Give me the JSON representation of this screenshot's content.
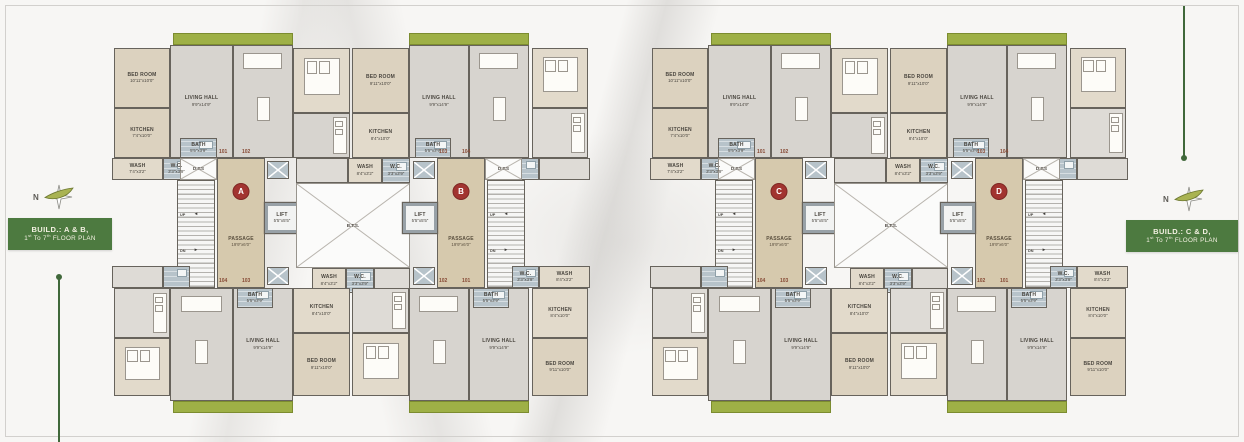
{
  "sheet": {
    "width": 1244,
    "height": 442,
    "background": "#f7f6f4"
  },
  "colors": {
    "wall": "#67635c",
    "room_beige": "#dcd2bf",
    "room_gray": "#d7d4cf",
    "bath_blue": "#b7c3ca",
    "balcony_green": "#9eb046",
    "title_green": "#4d7a40",
    "unit_circle_red": "#a23430",
    "unit_number": "#874a35",
    "line_green": "#40683a"
  },
  "annotations": {
    "left": {
      "n": "N",
      "line1": "BUILD.: A & B,",
      "line2": [
        "1",
        "st",
        " To 7",
        "th",
        " FLOOR PLAN"
      ]
    },
    "right": {
      "n": "N",
      "line1": "BUILD.: C & D,",
      "line2": [
        "1",
        "st",
        " To 7",
        "th",
        " FLOOR PLAN"
      ]
    }
  },
  "labels": {
    "passage": "PASSAGE",
    "passage_dims": "19'9\"x6'0\"",
    "lift": "LIFT",
    "lift_dims": "5'5\"x5'5\"",
    "dts": "D.T.S",
    "bts": "B.T.S.",
    "up": "UP",
    "dn": "DN",
    "arrow_left": "◄",
    "arrow_right": "►"
  },
  "plans": [
    {
      "name": "plan-build-ab",
      "x": 112,
      "letters": [
        "A",
        "B"
      ]
    },
    {
      "name": "plan-build-cd",
      "x": 650,
      "letters": [
        "C",
        "D"
      ]
    }
  ],
  "plan_template": {
    "items": [
      {
        "type": "green",
        "id": "balcony-top-left",
        "x": 61,
        "y": 2,
        "w": 120,
        "h": 12
      },
      {
        "type": "green",
        "id": "balcony-top-right",
        "x": 297,
        "y": 2,
        "w": 120,
        "h": 12
      },
      {
        "type": "green",
        "id": "balcony-bottom-left",
        "x": 61,
        "y": 370,
        "w": 120,
        "h": 12
      },
      {
        "type": "green",
        "id": "balcony-bottom-right",
        "x": 297,
        "y": 370,
        "w": 120,
        "h": 12
      },
      {
        "type": "room",
        "id": "bedroom-101",
        "x": 2,
        "y": 17,
        "w": 56,
        "h": 60,
        "fill": "beige",
        "label": [
          "BED ROOM",
          "10'11\"x10'0\""
        ]
      },
      {
        "type": "room",
        "id": "living-hall-101",
        "x": 58,
        "y": 14,
        "w": 63,
        "h": 113,
        "fill": "gray",
        "label": [
          "LIVING HALL",
          "9'9\"x14'9\""
        ]
      },
      {
        "type": "room",
        "id": "kitchen-101",
        "x": 2,
        "y": 77,
        "w": 56,
        "h": 50,
        "fill": "beige",
        "label": [
          "KITCHEN",
          "7'4\"x10'0\""
        ]
      },
      {
        "type": "room",
        "id": "wash-101",
        "x": 0,
        "y": 127,
        "w": 51,
        "h": 22,
        "fill": "beige2",
        "label": [
          "WASH",
          "7'4\"x3'2\""
        ]
      },
      {
        "type": "room",
        "id": "wc-101",
        "x": 51,
        "y": 127,
        "w": 27,
        "h": 22,
        "fill": "blue",
        "label": [
          "W.C.",
          "3'3\"x3'9\""
        ]
      },
      {
        "type": "room",
        "id": "bath-101",
        "x": 68,
        "y": 107,
        "w": 37,
        "h": 20,
        "fill": "blue",
        "label": [
          "BATH",
          "5'5\"x3'9\""
        ]
      },
      {
        "type": "room",
        "id": "living-hall-102",
        "x": 121,
        "y": 14,
        "w": 60,
        "h": 113,
        "fill": "gray",
        "furn": "sofa"
      },
      {
        "type": "room",
        "id": "bedroom-102",
        "x": 181,
        "y": 17,
        "w": 57,
        "h": 65,
        "fill": "beige2",
        "furn": "bed"
      },
      {
        "type": "room",
        "id": "kitchen-102",
        "x": 181,
        "y": 82,
        "w": 57,
        "h": 45,
        "fill": "gray",
        "furn": "kitchen"
      },
      {
        "type": "room",
        "id": "service-102",
        "x": 184,
        "y": 127,
        "w": 52,
        "h": 25,
        "fill": "gray2"
      },
      {
        "type": "room",
        "id": "wash-103-top",
        "x": 236,
        "y": 127,
        "w": 34,
        "h": 25,
        "fill": "beige2",
        "label": [
          "WASH",
          "8'4\"x3'2\""
        ]
      },
      {
        "type": "room",
        "id": "wc-103-top",
        "x": 270,
        "y": 127,
        "w": 28,
        "h": 25,
        "fill": "blue",
        "label": [
          "W.C.",
          "3'3\"x3'9\""
        ]
      },
      {
        "type": "room",
        "id": "bedroom-103",
        "x": 240,
        "y": 17,
        "w": 57,
        "h": 65,
        "fill": "beige",
        "label": [
          "BED ROOM",
          "9'11\"x10'0\""
        ]
      },
      {
        "type": "room",
        "id": "kitchen-103",
        "x": 240,
        "y": 82,
        "w": 57,
        "h": 45,
        "fill": "beige2",
        "label": [
          "KITCHEN",
          "8'4\"x10'0\""
        ]
      },
      {
        "type": "room",
        "id": "living-hall-103",
        "x": 297,
        "y": 14,
        "w": 60,
        "h": 113,
        "fill": "gray",
        "label": [
          "LIVING HALL",
          "9'9\"x14'9\""
        ]
      },
      {
        "type": "room",
        "id": "bath-103",
        "x": 303,
        "y": 107,
        "w": 36,
        "h": 20,
        "fill": "blue",
        "label": [
          "BATH",
          "5'5\"x3'9\""
        ]
      },
      {
        "type": "room",
        "id": "living-hall-104",
        "x": 357,
        "y": 14,
        "w": 60,
        "h": 113,
        "fill": "gray",
        "furn": "sofa"
      },
      {
        "type": "room",
        "id": "bedroom-104",
        "x": 420,
        "y": 17,
        "w": 56,
        "h": 60,
        "fill": "beige2",
        "furn": "bed"
      },
      {
        "type": "room",
        "id": "kitchen-104",
        "x": 420,
        "y": 77,
        "w": 56,
        "h": 50,
        "fill": "gray2",
        "furn": "kitchen"
      },
      {
        "type": "room",
        "id": "wash-104",
        "x": 427,
        "y": 127,
        "w": 51,
        "h": 22,
        "fill": "gray2"
      },
      {
        "type": "room",
        "id": "wc-104",
        "x": 400,
        "y": 127,
        "w": 27,
        "h": 22,
        "fill": "blue"
      },
      {
        "type": "dts",
        "id": "dts-left",
        "x": 68,
        "y": 127,
        "w": 37,
        "h": 22
      },
      {
        "type": "stairs",
        "id": "staircase-left",
        "x": 65,
        "y": 149,
        "w": 38,
        "h": 108
      },
      {
        "type": "passage",
        "id": "passage-left",
        "x": 105,
        "y": 127,
        "w": 48,
        "h": 130,
        "li": 0
      },
      {
        "type": "lift",
        "id": "lift-left",
        "x": 153,
        "y": 172,
        "w": 34,
        "h": 30
      },
      {
        "type": "bluebox",
        "id": "duct-left-top",
        "x": 155,
        "y": 130,
        "w": 22,
        "h": 18
      },
      {
        "type": "bluebox",
        "id": "duct-left-bottom",
        "x": 155,
        "y": 236,
        "w": 22,
        "h": 18
      },
      {
        "type": "num",
        "id": "unit-101",
        "x": 107,
        "y": 118,
        "t": "101"
      },
      {
        "type": "num",
        "id": "unit-102",
        "x": 130,
        "y": 118,
        "t": "102"
      },
      {
        "type": "num",
        "id": "unit-104",
        "x": 107,
        "y": 247,
        "t": "104"
      },
      {
        "type": "num",
        "id": "unit-103",
        "x": 130,
        "y": 247,
        "t": "103"
      },
      {
        "type": "void",
        "id": "bts-void",
        "x": 184,
        "y": 152,
        "w": 114,
        "h": 85
      },
      {
        "type": "room",
        "id": "wash-103-bottom",
        "x": 200,
        "y": 237,
        "w": 34,
        "h": 25,
        "fill": "beige2",
        "label": [
          "WASH",
          "8'4\"x3'2\""
        ]
      },
      {
        "type": "room",
        "id": "wc-103-bottom",
        "x": 234,
        "y": 237,
        "w": 28,
        "h": 25,
        "fill": "blue",
        "label": [
          "W.C.",
          "3'3\"x3'9\""
        ]
      },
      {
        "type": "room",
        "id": "service-102-bottom",
        "x": 262,
        "y": 237,
        "w": 36,
        "h": 25,
        "fill": "gray2"
      },
      {
        "type": "dts",
        "id": "dts-right",
        "x": 373,
        "y": 127,
        "w": 37,
        "h": 22
      },
      {
        "type": "stairs",
        "id": "staircase-right",
        "x": 375,
        "y": 149,
        "w": 38,
        "h": 108
      },
      {
        "type": "passage",
        "id": "passage-right",
        "x": 325,
        "y": 127,
        "w": 48,
        "h": 130,
        "li": 1
      },
      {
        "type": "lift",
        "id": "lift-right",
        "x": 291,
        "y": 172,
        "w": 34,
        "h": 30
      },
      {
        "type": "bluebox",
        "id": "duct-right-top",
        "x": 301,
        "y": 130,
        "w": 22,
        "h": 18
      },
      {
        "type": "bluebox",
        "id": "duct-right-bottom",
        "x": 301,
        "y": 236,
        "w": 22,
        "h": 18
      },
      {
        "type": "num",
        "id": "unit-103b",
        "x": 327,
        "y": 118,
        "t": "103"
      },
      {
        "type": "num",
        "id": "unit-104b",
        "x": 350,
        "y": 118,
        "t": "104"
      },
      {
        "type": "num",
        "id": "unit-102b",
        "x": 327,
        "y": 247,
        "t": "102"
      },
      {
        "type": "num",
        "id": "unit-101b",
        "x": 350,
        "y": 247,
        "t": "101"
      },
      {
        "type": "room",
        "id": "kitchen-104-bottom",
        "x": 2,
        "y": 257,
        "w": 56,
        "h": 50,
        "fill": "gray2",
        "furn": "kitchen"
      },
      {
        "type": "room",
        "id": "bedroom-104-bottom",
        "x": 2,
        "y": 307,
        "w": 56,
        "h": 58,
        "fill": "beige2",
        "furn": "bed"
      },
      {
        "type": "room",
        "id": "living-hall-104-bottom",
        "x": 58,
        "y": 257,
        "w": 63,
        "h": 113,
        "fill": "gray",
        "furn": "sofa"
      },
      {
        "type": "room",
        "id": "wash-104-bottom",
        "x": 0,
        "y": 235,
        "w": 51,
        "h": 22,
        "fill": "gray2"
      },
      {
        "type": "room",
        "id": "wc-104-bottom",
        "x": 51,
        "y": 235,
        "w": 27,
        "h": 22,
        "fill": "blue"
      },
      {
        "type": "room",
        "id": "living-hall-103-bottom",
        "x": 121,
        "y": 257,
        "w": 60,
        "h": 113,
        "fill": "gray",
        "label": [
          "LIVING HALL",
          "9'9\"x14'9\""
        ]
      },
      {
        "type": "room",
        "id": "bath-103-bottom",
        "x": 125,
        "y": 257,
        "w": 36,
        "h": 20,
        "fill": "blue",
        "label": [
          "BATH",
          "5'5\"x3'9\""
        ]
      },
      {
        "type": "room",
        "id": "kitchen-103-bottom",
        "x": 181,
        "y": 257,
        "w": 57,
        "h": 45,
        "fill": "beige2",
        "label": [
          "KITCHEN",
          "8'4\"x10'0\""
        ]
      },
      {
        "type": "room",
        "id": "bedroom-103-bottom",
        "x": 181,
        "y": 302,
        "w": 57,
        "h": 63,
        "fill": "beige",
        "label": [
          "BED ROOM",
          "9'11\"x10'0\""
        ]
      },
      {
        "type": "room",
        "id": "kitchen-102-bottom",
        "x": 240,
        "y": 257,
        "w": 57,
        "h": 45,
        "fill": "gray2",
        "furn": "kitchen"
      },
      {
        "type": "room",
        "id": "bedroom-102-bottom",
        "x": 240,
        "y": 302,
        "w": 57,
        "h": 63,
        "fill": "beige2",
        "furn": "bed"
      },
      {
        "type": "room",
        "id": "living-hall-102-bottom",
        "x": 297,
        "y": 257,
        "w": 60,
        "h": 113,
        "fill": "gray",
        "furn": "sofa"
      },
      {
        "type": "room",
        "id": "living-hall-101-bottom",
        "x": 357,
        "y": 257,
        "w": 60,
        "h": 113,
        "fill": "gray",
        "label": [
          "LIVING HALL",
          "9'9\"x14'9\""
        ]
      },
      {
        "type": "room",
        "id": "bath-101-bottom",
        "x": 361,
        "y": 257,
        "w": 36,
        "h": 20,
        "fill": "blue",
        "label": [
          "BATH",
          "5'5\"x3'9\""
        ]
      },
      {
        "type": "room",
        "id": "kitchen-101-bottom",
        "x": 420,
        "y": 257,
        "w": 56,
        "h": 50,
        "fill": "beige2",
        "label": [
          "KITCHEN",
          "8'4\"x10'0\""
        ]
      },
      {
        "type": "room",
        "id": "bedroom-101-bottom",
        "x": 420,
        "y": 307,
        "w": 56,
        "h": 58,
        "fill": "beige",
        "label": [
          "BED ROOM",
          "9'11\"x10'0\""
        ]
      },
      {
        "type": "room",
        "id": "wash-101-bottom",
        "x": 427,
        "y": 235,
        "w": 51,
        "h": 22,
        "fill": "beige2",
        "label": [
          "WASH",
          "8'4\"x3'2\""
        ]
      },
      {
        "type": "room",
        "id": "wc-101-bottom",
        "x": 400,
        "y": 235,
        "w": 27,
        "h": 22,
        "fill": "blue",
        "label": [
          "W.C.",
          "3'3\"x3'9\""
        ]
      }
    ]
  }
}
